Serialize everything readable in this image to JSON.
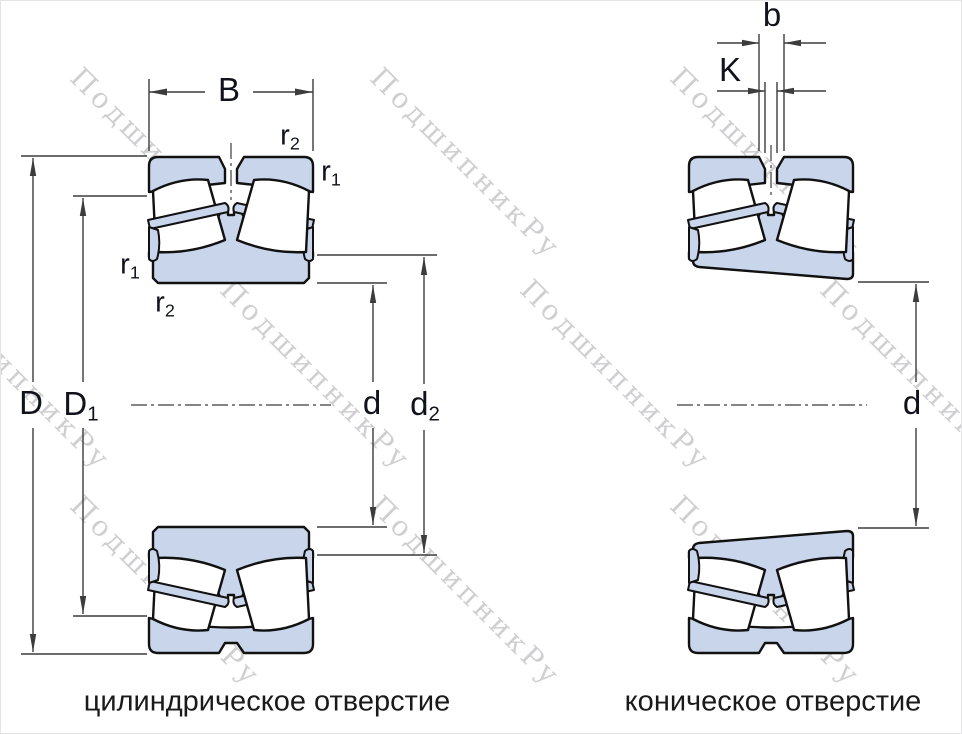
{
  "watermark": {
    "text": "ПодшипникРу"
  },
  "labels": {
    "B": {
      "text": "B",
      "sub": ""
    },
    "D": {
      "text": "D",
      "sub": ""
    },
    "D1": {
      "text": "D",
      "sub": "1"
    },
    "d": {
      "text": "d",
      "sub": ""
    },
    "d2": {
      "text": "d",
      "sub": "2"
    },
    "d_right": {
      "text": "d",
      "sub": ""
    },
    "b": {
      "text": "b",
      "sub": ""
    },
    "K": {
      "text": "K",
      "sub": ""
    },
    "r1_top": {
      "text": "r",
      "sub": "1"
    },
    "r2_top": {
      "text": "r",
      "sub": "2"
    },
    "r1_left": {
      "text": "r",
      "sub": "1"
    },
    "r2_left": {
      "text": "r",
      "sub": "2"
    }
  },
  "figures": {
    "left": {
      "caption": "цилиндрическое отверстие"
    },
    "right": {
      "caption": "коническое отверстие"
    }
  },
  "colors": {
    "ring_fill": "#c8d5eb",
    "outline": "#111111",
    "dimension_lines": "#3c3c3c",
    "label_text": "#10131c",
    "caption_text": "#1a1a1a"
  }
}
